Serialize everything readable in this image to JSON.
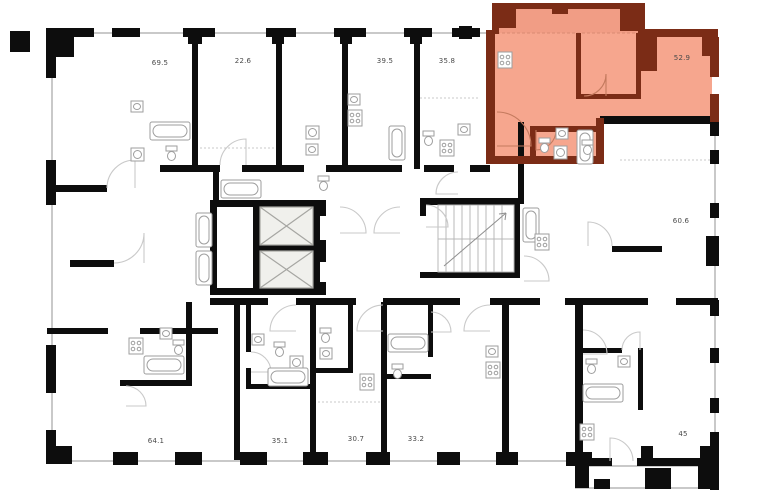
{
  "plan": {
    "type": "building-floor-plan",
    "units": [
      {
        "area": "69.5",
        "highlighted": false
      },
      {
        "area": "22.6",
        "highlighted": false
      },
      {
        "area": "39.5",
        "highlighted": false
      },
      {
        "area": "35.8",
        "highlighted": false
      },
      {
        "area": "52.9",
        "highlighted": true
      },
      {
        "area": "60.6",
        "highlighted": false
      },
      {
        "area": "45",
        "highlighted": false
      },
      {
        "area": "64.1",
        "highlighted": false
      },
      {
        "area": "35.1",
        "highlighted": false
      },
      {
        "area": "30.7",
        "highlighted": false
      },
      {
        "area": "33.2",
        "highlighted": false
      }
    ],
    "colors": {
      "wall": "#0d0d0d",
      "highlight_fill": "#f6a68e",
      "highlight_fill_loggia": "#f19d85",
      "highlight_wall": "#7b2c16",
      "window_line": "#c9c9c9",
      "fixture_line": "#9e9e9e",
      "shaft_fill": "#f0f0ec",
      "label_text": "#4a4a4a",
      "background": "#ffffff"
    }
  }
}
